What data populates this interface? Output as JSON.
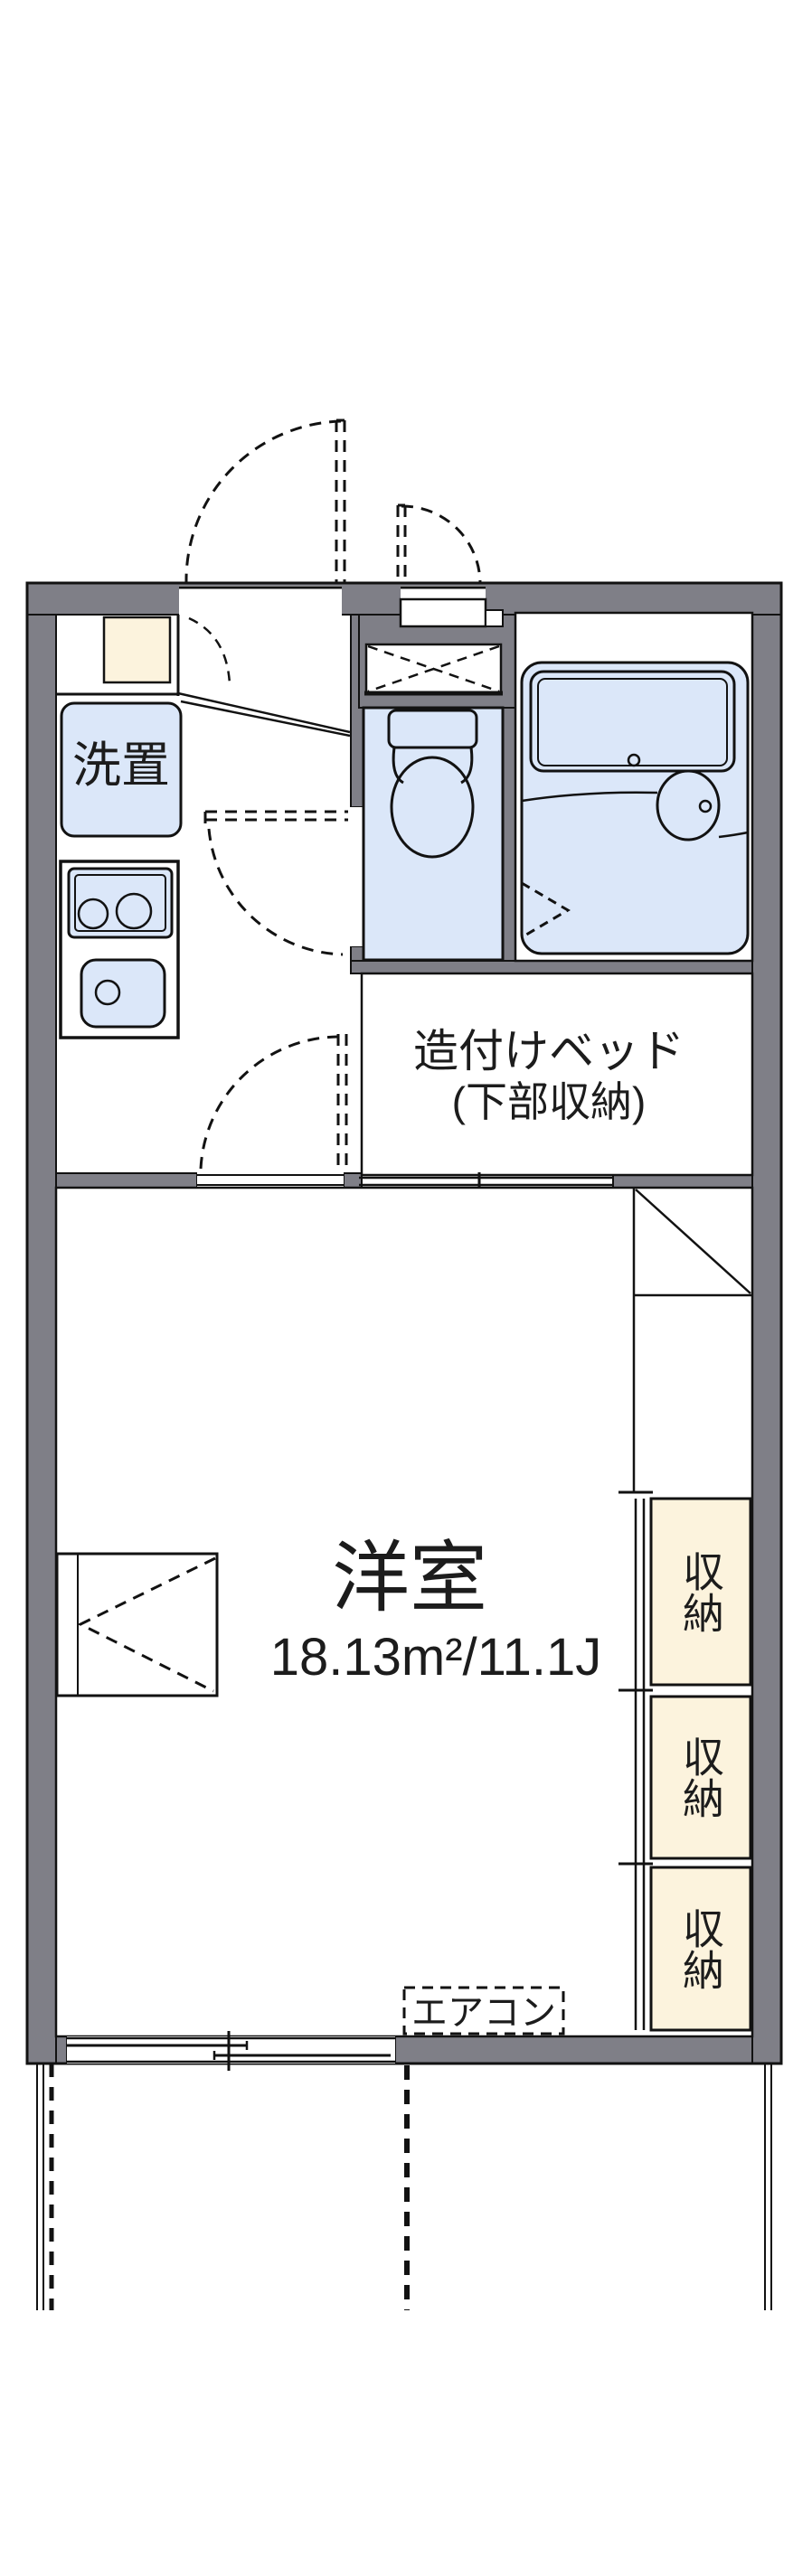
{
  "page": {
    "background": "#ffffff",
    "type": "apartment-floor-plan"
  },
  "colors": {
    "wall_gray": "#7f7f87",
    "fixture_blue": "#dbe7f9",
    "storage_cream": "#fcf3dd",
    "line_black": "#121212"
  },
  "labels": {
    "laundry": "洗置",
    "built_in_bed_line1": "造付けベッド",
    "built_in_bed_line2": "(下部収納)",
    "main_room_name": "洋室",
    "main_room_size": "18.13m²/11.1J",
    "storage_units": [
      "収納",
      "収納",
      "収納"
    ],
    "air_conditioner": "エアコン"
  }
}
